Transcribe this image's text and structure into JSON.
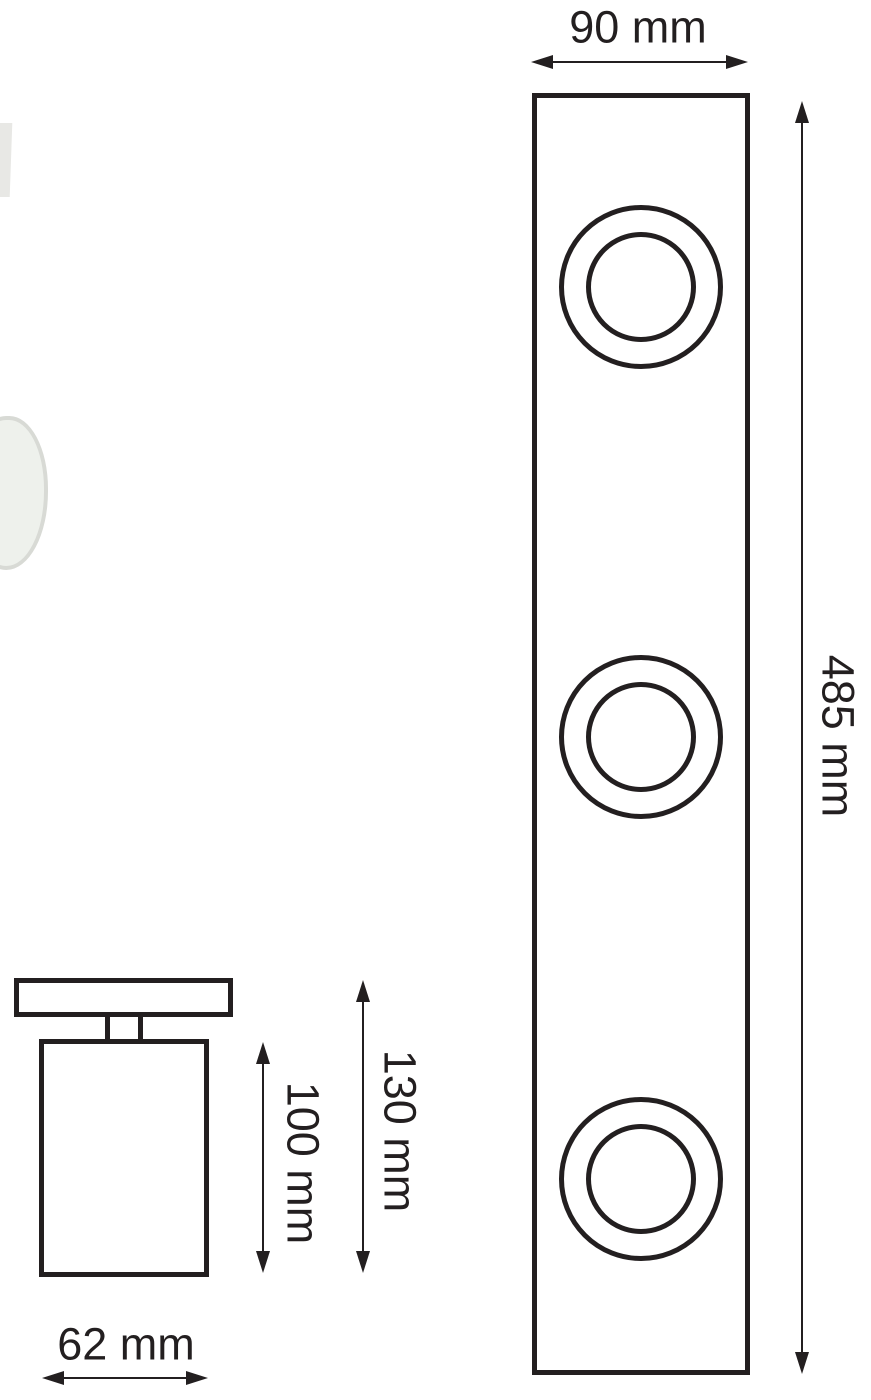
{
  "diagram": {
    "title": "spotlight-bar-dimension-drawing",
    "front_view": {
      "width_label": "90 mm",
      "height_label": "485 mm",
      "spot_count": 3
    },
    "side_view": {
      "body_height_label": "100 mm",
      "total_height_label": "130 mm",
      "width_label": "62 mm"
    },
    "colors": {
      "stroke": "#231f20",
      "background": "#ffffff",
      "photo_fill": "#eef1ec",
      "photo_outline": "#d8dad5"
    }
  }
}
